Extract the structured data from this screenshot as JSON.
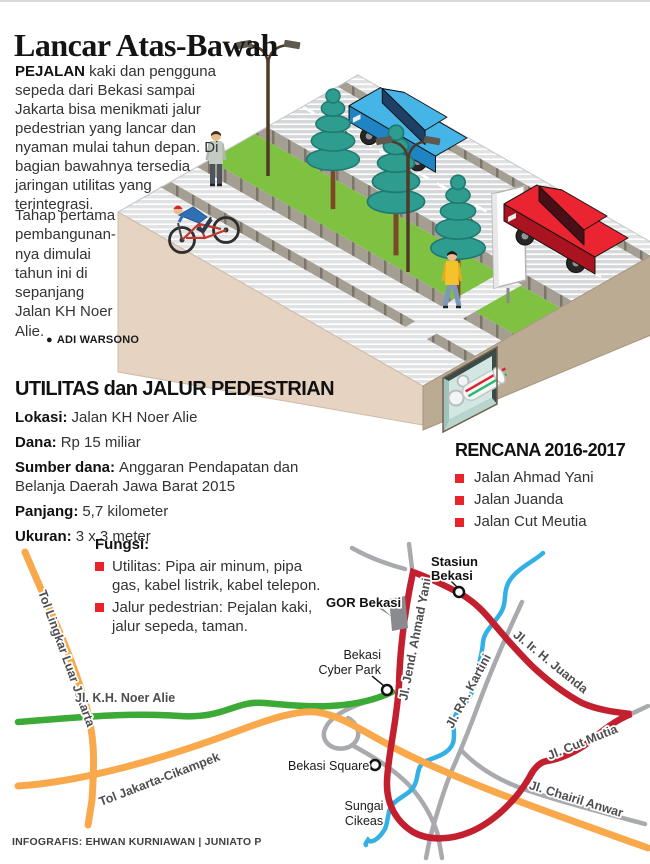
{
  "title": "Lancar Atas-Bawah",
  "intro": {
    "lead_word": "PEJALAN",
    "part1_rest": " kaki dan pengguna sepeda dari Bekasi sampai Jakarta bisa menikmati jalur pedestrian yang lancar dan nyaman mulai tahun depan. Di bagian bawahnya tersedia jaringan utilitas yang terintegrasi.",
    "part2": "Tahap pertama pembangunan-nya dimulai tahun ini di sepanjang Jalan KH Noer Alie.",
    "byline_bullet": "●",
    "byline": "ADI WARSONO"
  },
  "specs": {
    "heading": "UTILITAS dan JALUR PEDESTRIAN",
    "items": [
      {
        "label": "Lokasi:",
        "value": "Jalan KH Noer Alie"
      },
      {
        "label": "Dana:",
        "value": "Rp 15 miliar"
      },
      {
        "label": "Sumber dana:",
        "value": "Anggaran Pendapatan dan Belanja Daerah Jawa Barat 2015"
      },
      {
        "label": "Panjang:",
        "value": "5,7 kilometer"
      },
      {
        "label": "Ukuran:",
        "value": "3 x 3 meter"
      }
    ]
  },
  "rencana": {
    "heading": "RENCANA 2016-2017",
    "items": [
      "Jalan Ahmad Yani",
      "Jalan Juanda",
      "Jalan Cut Meutia"
    ]
  },
  "fungsi": {
    "heading": "Fungsi:",
    "items": [
      "Utilitas: Pipa air minum, pipa gas, kabel listrik, kabel telepon.",
      "Jalur pedestrian: Pejalan kaki, jalur sepeda, taman."
    ]
  },
  "map": {
    "road_labels": {
      "tol_lingkar": "Tol Lingkar Luar Jakarta",
      "tol_cikampek": "Tol Jakarta-Cikampek",
      "noer_alie": "Jl. K.H. Noer Alie",
      "ahmad_yani": "Jl. Jend. Ahmad Yani",
      "juanda": "Jl. Ir. H. Juanda",
      "kartini": "Jl. RA. Kartini",
      "cut_mutia": "Jl. Cut Mutia",
      "chairil_anwar": "Jl. Chairil Anwar"
    },
    "places": {
      "stasiun": [
        "Stasiun",
        "Bekasi"
      ],
      "gor": "GOR Bekasi",
      "cyber": [
        "Bekasi",
        "Cyber Park"
      ],
      "square": "Bekasi Square",
      "sungai": [
        "Sungai",
        "Cikeas"
      ]
    }
  },
  "credit": "INFOGRAFIS: EHWAN KURNIAWAN | JUNIATO P",
  "colors": {
    "bullet_red": "#E8232A",
    "road_red": "#C3202F",
    "road_orange": "#F9A94B",
    "road_green": "#3BAA36",
    "river_blue": "#33B1E5",
    "road_gray": "#A8AAAD",
    "grass_green": "#7FC242",
    "block_tan_light": "#E6D3C2",
    "block_tan_dark": "#BCAB93"
  }
}
